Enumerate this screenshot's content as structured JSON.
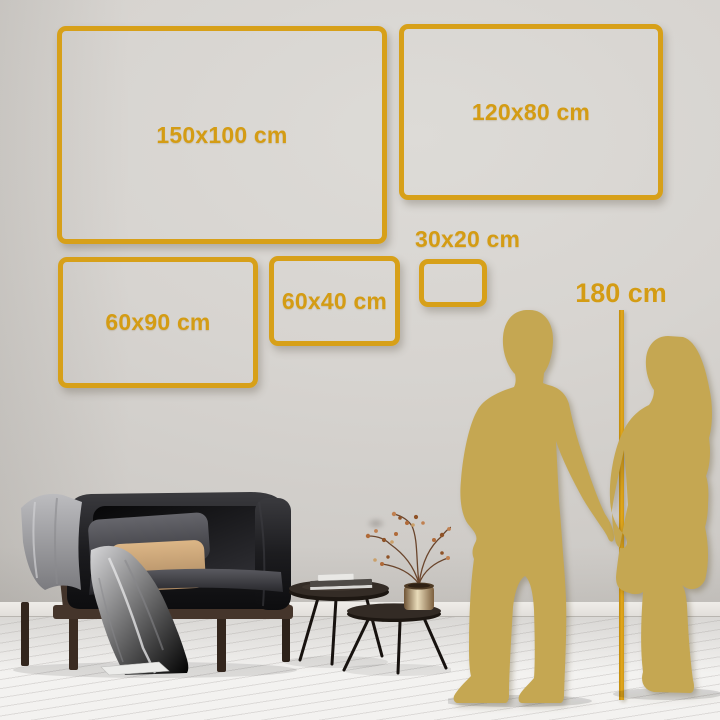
{
  "size_guide": {
    "frames": [
      {
        "label": "150x100 cm",
        "width_cm": 150,
        "height_cm": 100
      },
      {
        "label": "120x80 cm",
        "width_cm": 120,
        "height_cm": 80
      },
      {
        "label": "60x90 cm",
        "width_cm": 90,
        "height_cm": 60
      },
      {
        "label": "60x40 cm",
        "width_cm": 60,
        "height_cm": 40
      },
      {
        "label": "30x20 cm",
        "width_cm": 30,
        "height_cm": 20
      }
    ],
    "height_reference": {
      "label": "180 cm",
      "height_cm": 180
    }
  },
  "colors": {
    "accent_gold": "#d7a019",
    "silhouette_gold": "#c5a752",
    "wall": "#d7d4d0",
    "floor": "#f2f1ef"
  },
  "icons": {
    "man": "man-silhouette",
    "woman": "woman-silhouette",
    "sofa": "sofa-illustration",
    "tables": "coffee-tables-illustration",
    "plant": "vase-with-branches"
  }
}
